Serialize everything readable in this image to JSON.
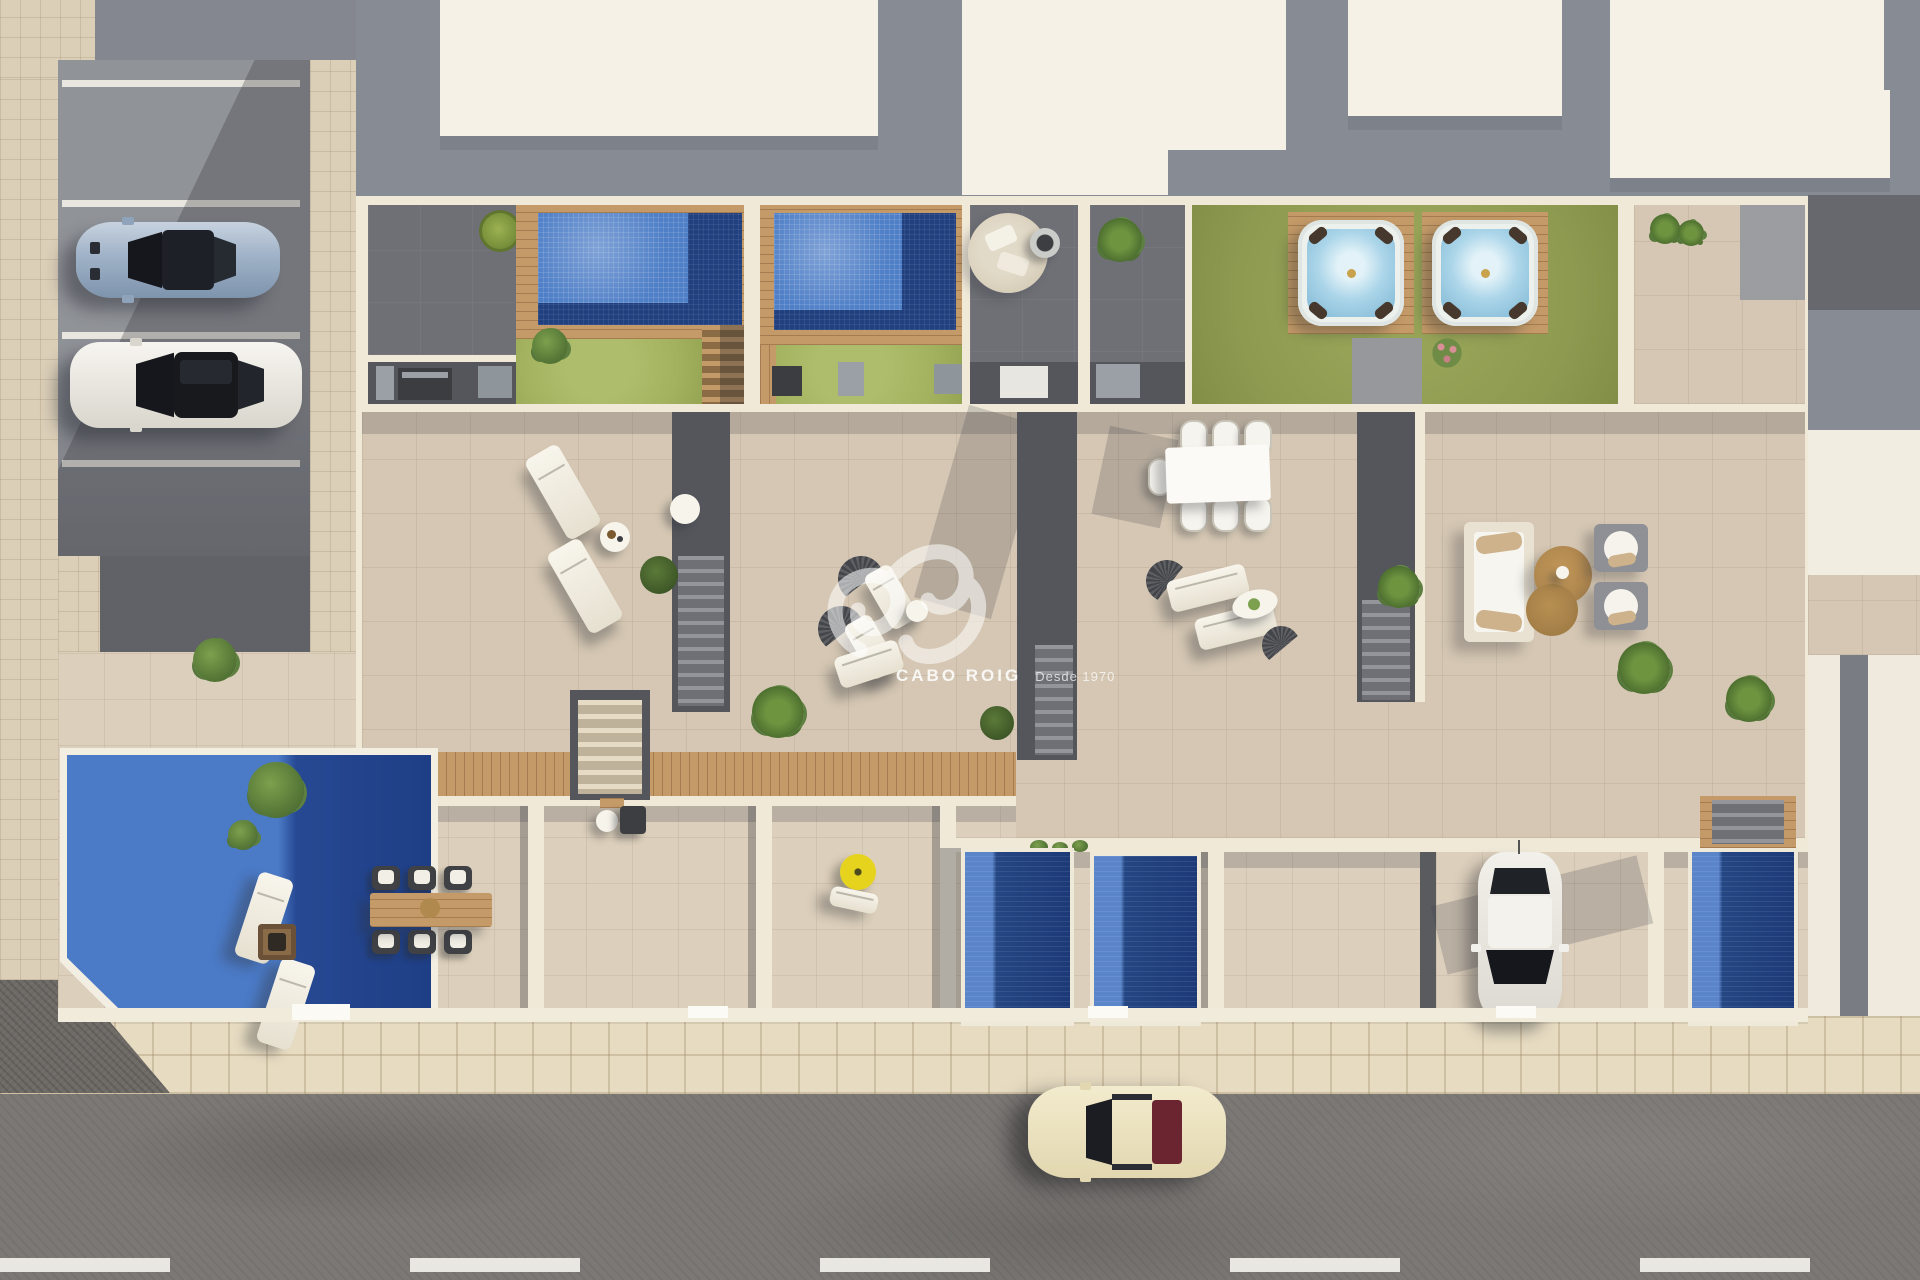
{
  "meta": {
    "description": "Aerial top-down 3D architectural render of a row of modern villas with rooftop solarium pools, hot tubs, tiled terraces, private ground-floor pools, a parking area, a sidewalk and a street",
    "style": "photorealistic-render",
    "watermark_present": true
  },
  "watermark": {
    "logo": "swirl-script-logo",
    "brand": "CABO ROIG",
    "tagline": "Desde 1970",
    "color": "#ffffff"
  },
  "palette": {
    "roof_white": "#f6f1e6",
    "roof_gray": "#878b94",
    "terrace_gray": "#6e7076",
    "dark_strip": "#54565c",
    "beige_tile": "#d5c7b3",
    "beige_tile_light": "#dccfbb",
    "cream_wall": "#f0e9d8",
    "sidewalk": "#e7dcc2",
    "road_asphalt": "#7b7875",
    "gravel": "#6e6a66",
    "pool_light_blue": "#4f7fc7",
    "pool_navy": "#1e3e85",
    "lawn_green": "#a3b25f",
    "lawn_olive": "#8e9a50",
    "wood_deck": "#c49a68",
    "hot_tub_water": "#abd5e9",
    "parasol_yellow": "#e6d31d",
    "coffee_table_tan": "#b08a4e"
  },
  "inventory": {
    "rooftop_pools": 2,
    "hot_tubs": 2,
    "ground_pools": 4,
    "green_lawns": 3,
    "vehicles": [
      {
        "name": "silver-sports-car",
        "location": "parking-stall",
        "color": "#9fb2c7"
      },
      {
        "name": "white-sedan",
        "location": "parking-stall",
        "color": "#f2f0ea"
      },
      {
        "name": "white-compact-car",
        "location": "driveway",
        "color": "#f2f0ea"
      },
      {
        "name": "cream-classic-car",
        "location": "street",
        "color": "#ece3c1"
      }
    ],
    "furniture": [
      "sun-loungers",
      "round-side-tables",
      "white-dining-table-six-chairs",
      "wicker-dining-set",
      "garden-sofa-set",
      "armchairs",
      "tan-round-coffee-tables",
      "fire-pit-table",
      "yellow-parasol",
      "outdoor-kitchen-units",
      "round-lounge-rug",
      "fire-bowl"
    ],
    "markings": {
      "road": "white-dashed-center-line",
      "parking": "white-stall-lines"
    }
  }
}
